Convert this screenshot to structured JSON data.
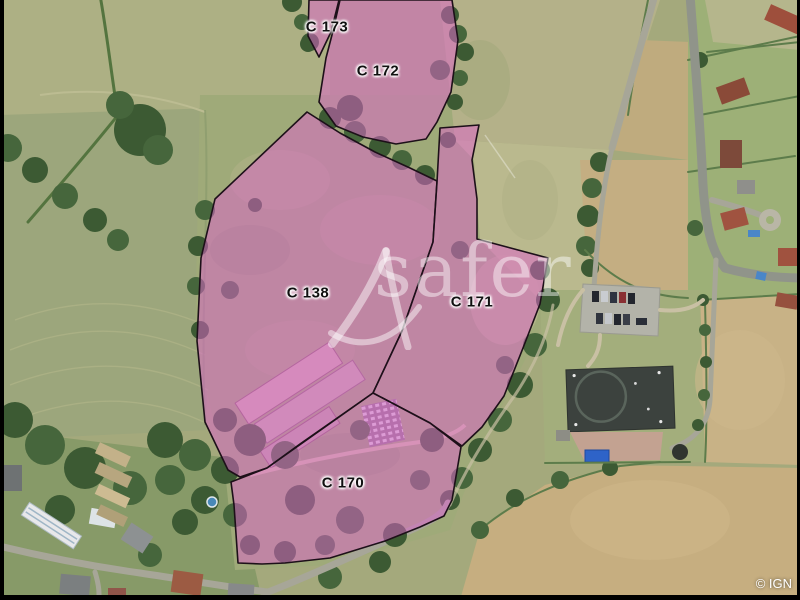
{
  "map": {
    "watermark": {
      "brand": "safer",
      "logo_icon": "safer-delta-logo"
    },
    "attribution": "© IGN",
    "overlay_color": "#e062ce",
    "outline_color": "#1d1019",
    "parcels": [
      {
        "label": "C 173"
      },
      {
        "label": "C 172"
      },
      {
        "label": "C 138"
      },
      {
        "label": "C 171"
      },
      {
        "label": "C 170"
      }
    ]
  }
}
